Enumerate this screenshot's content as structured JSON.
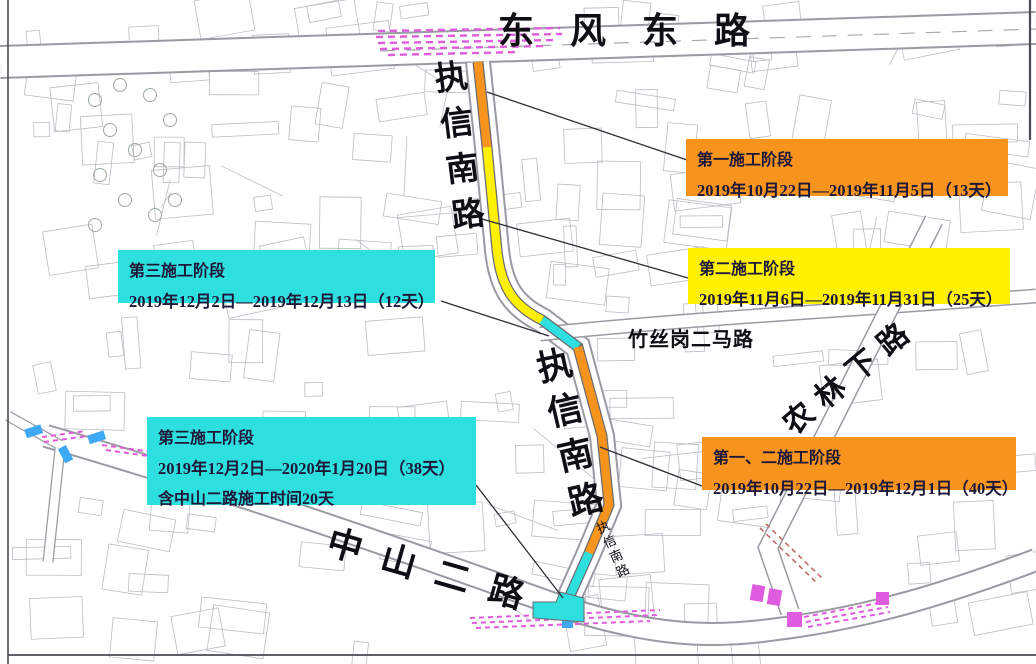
{
  "map": {
    "streets": {
      "dongfeng_east_road": "东风东路",
      "zhixin_south_road_north": "执信南路",
      "zhushigang_2nd_road": "竹丝岗二马路",
      "zhixin_south_road_mid": "执信南路",
      "zhixin_south_road_small": "执信南路",
      "nonglin_xia_road": "农林下路",
      "zhongshan_2nd_road": "中山二路"
    },
    "phases": [
      {
        "name": "第一施工阶段",
        "dates": "2019年10月22日—2019年11月5日（13天）",
        "color": "#F7941E"
      },
      {
        "name": "第二施工阶段",
        "dates": "2019年11月6日—2019年11月31日（25天）",
        "color": "#FFF100"
      },
      {
        "name": "第三施工阶段",
        "dates": "2019年12月2日—2019年12月13日（12天）",
        "color": "#2EDFDF"
      },
      {
        "name": "第三施工阶段",
        "dates": "2019年12月2日—2020年1月20日（38天）",
        "note": "含中山二路施工时间20天",
        "color": "#2EDFDF"
      },
      {
        "name": "第一、二施工阶段",
        "dates": "2019年10月22日—2019年12月1日（40天）",
        "color": "#F7941E"
      }
    ],
    "colors": {
      "phase1_orange": "#F7941E",
      "phase2_yellow": "#FFF100",
      "phase3_cyan": "#2EDFDF",
      "marking_magenta": "#E05CDE",
      "marking_blue": "#3FA9F5",
      "marking_red": "#C46A6A",
      "road_edge_gray": "#9A9AA2",
      "building_gray": "#BCBCC4",
      "label_text": "#1E1838",
      "leader_line": "#2E2E34"
    }
  }
}
